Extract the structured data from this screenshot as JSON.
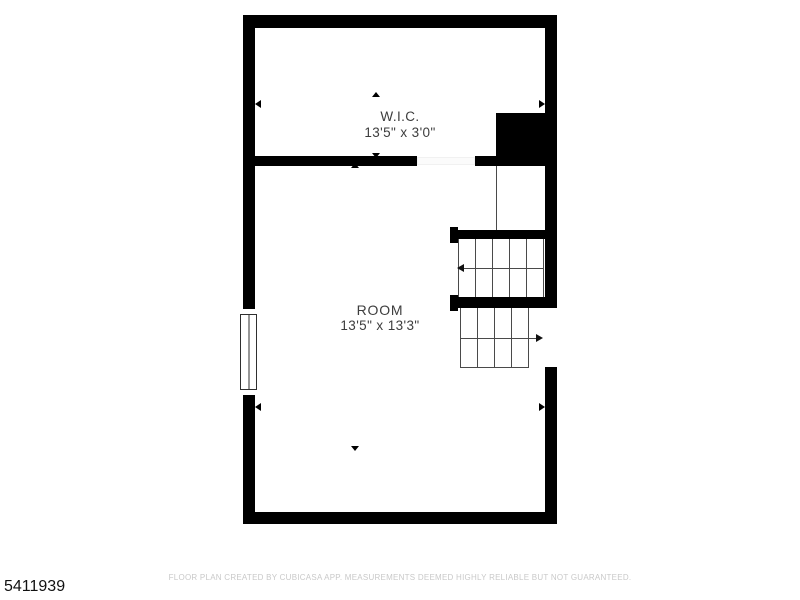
{
  "floor_plan": {
    "rooms": [
      {
        "name": "W.I.C.",
        "dimensions": "13'5\" x 3'0\""
      },
      {
        "name": "ROOM",
        "dimensions": "13'5\" x 13'3\""
      }
    ],
    "features": [
      "window",
      "door-opening",
      "staircase-upper-flight",
      "staircase-lower-flight",
      "solid-wall-block"
    ],
    "colors": {
      "wall": "#000000",
      "stair_line": "#4a4a4a",
      "label_text": "#3d3d3d",
      "footer_text": "#c9c9c9",
      "id_text": "#111111"
    }
  },
  "footer": {
    "disclaimer": "FLOOR PLAN CREATED BY CUBICASA APP. MEASUREMENTS DEEMED HIGHLY RELIABLE BUT NOT GUARANTEED."
  },
  "listing_id": "5411939"
}
